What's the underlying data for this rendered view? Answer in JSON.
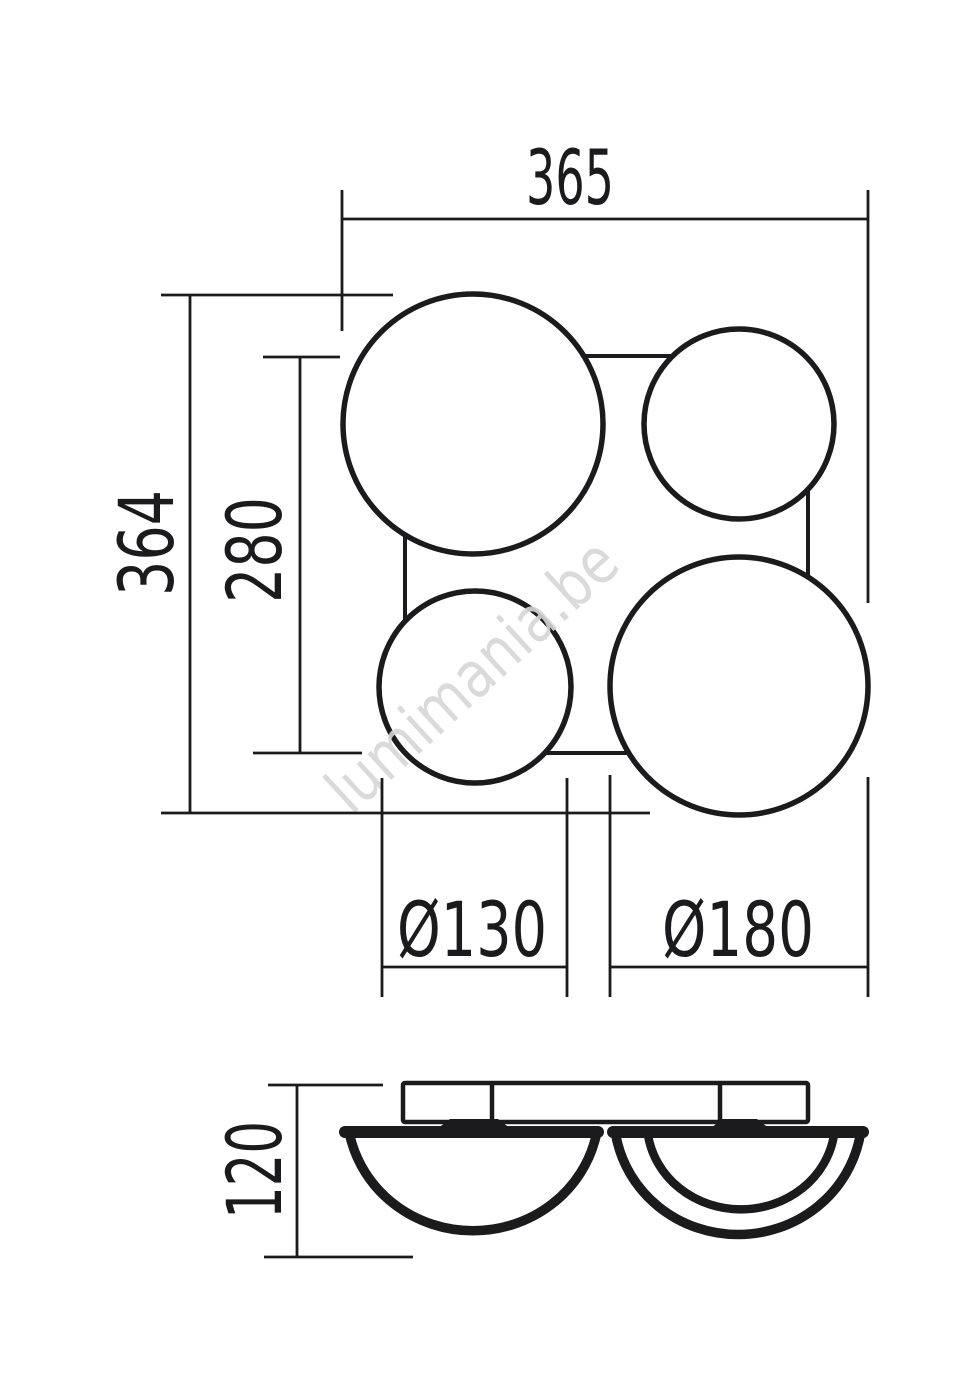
{
  "drawing": {
    "watermark": "lumimania.be",
    "colors": {
      "line": "#1b1b1e",
      "watermark": "#d6d6d6",
      "background": "#ffffff"
    },
    "top_view": {
      "overall_width_label": "365",
      "overall_height_label": "364",
      "frame_height_label": "280",
      "small_globe_diameter_label": "Ø130",
      "large_globe_diameter_label": "Ø180"
    },
    "side_view": {
      "fixture_height_label": "120"
    }
  }
}
